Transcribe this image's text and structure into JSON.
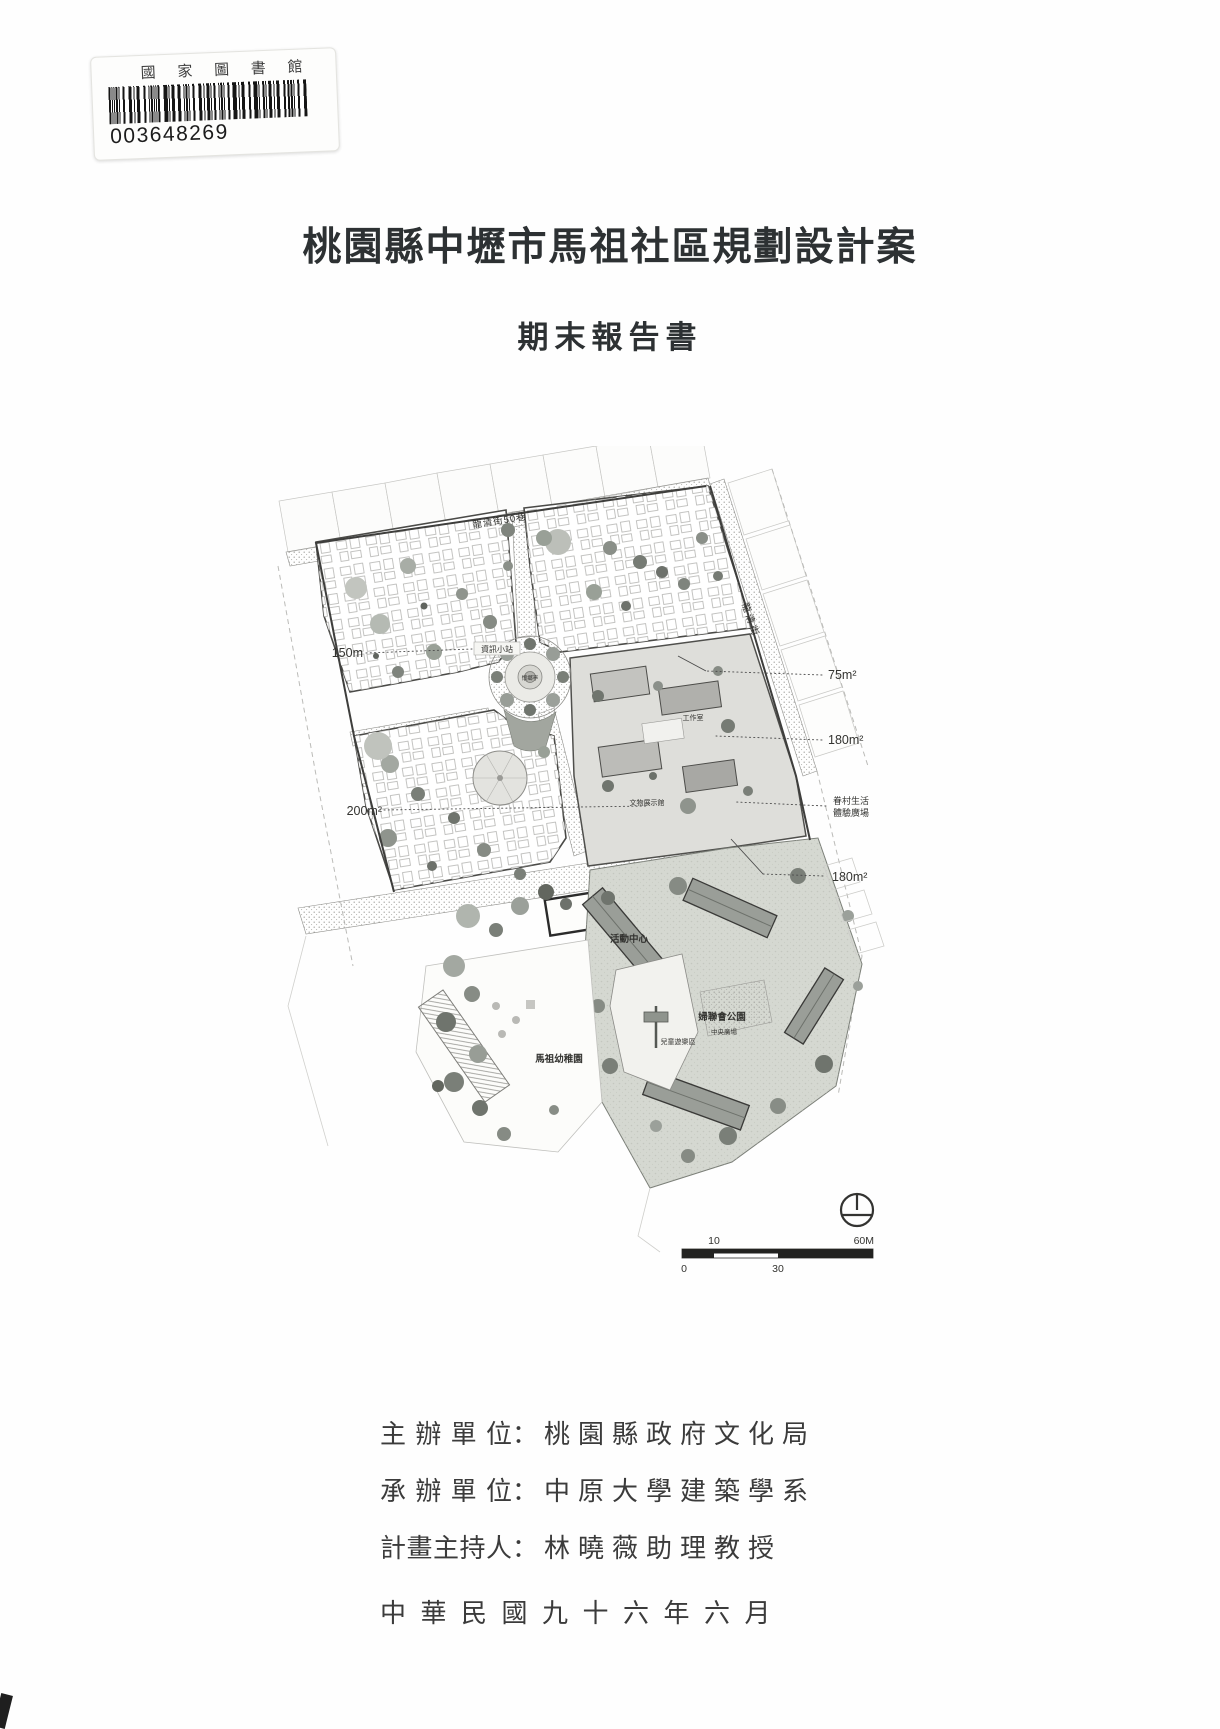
{
  "library_sticker": {
    "name": "國 家 圖 書 館",
    "barcode_digits": "003648269"
  },
  "title": "桃園縣中壢市馬祖社區規劃設計案",
  "subtitle": "期末報告書",
  "site_plan": {
    "streets": {
      "top": "龍清街50巷",
      "right": "龍清街"
    },
    "places": {
      "info_station": "資訊小站",
      "pavilion": "懷鄉亭",
      "workshop": "工作室",
      "artifact_hall": "文物展示館",
      "activity_center": "活動中心",
      "kindergarten": "馬祖幼稚園",
      "park": "婦聯會公園",
      "central_plaza": "中央廣場",
      "children_play_area": "兒童遊樂區"
    },
    "annotations": {
      "area_150m": "150m",
      "area_200m2": "200m²",
      "area_75m2": "75m²",
      "area_180m2_a": "180m²",
      "village_plaza_line1": "眷村生活",
      "village_plaza_line2": "體驗廣場",
      "area_180m2_b": "180m²"
    },
    "scale_bar": {
      "above_left": "10",
      "above_right": "60M",
      "below_left": "0",
      "below_mid": "30"
    }
  },
  "credits": {
    "separator": "：",
    "lines": [
      {
        "label": "主辦單位",
        "value": "桃園縣政府文化局"
      },
      {
        "label": "承辦單位",
        "value": "中原大學建築學系"
      },
      {
        "label": "計畫主持人",
        "value": "林曉薇助理教授"
      }
    ],
    "date": "中華民國九十六年六月"
  }
}
